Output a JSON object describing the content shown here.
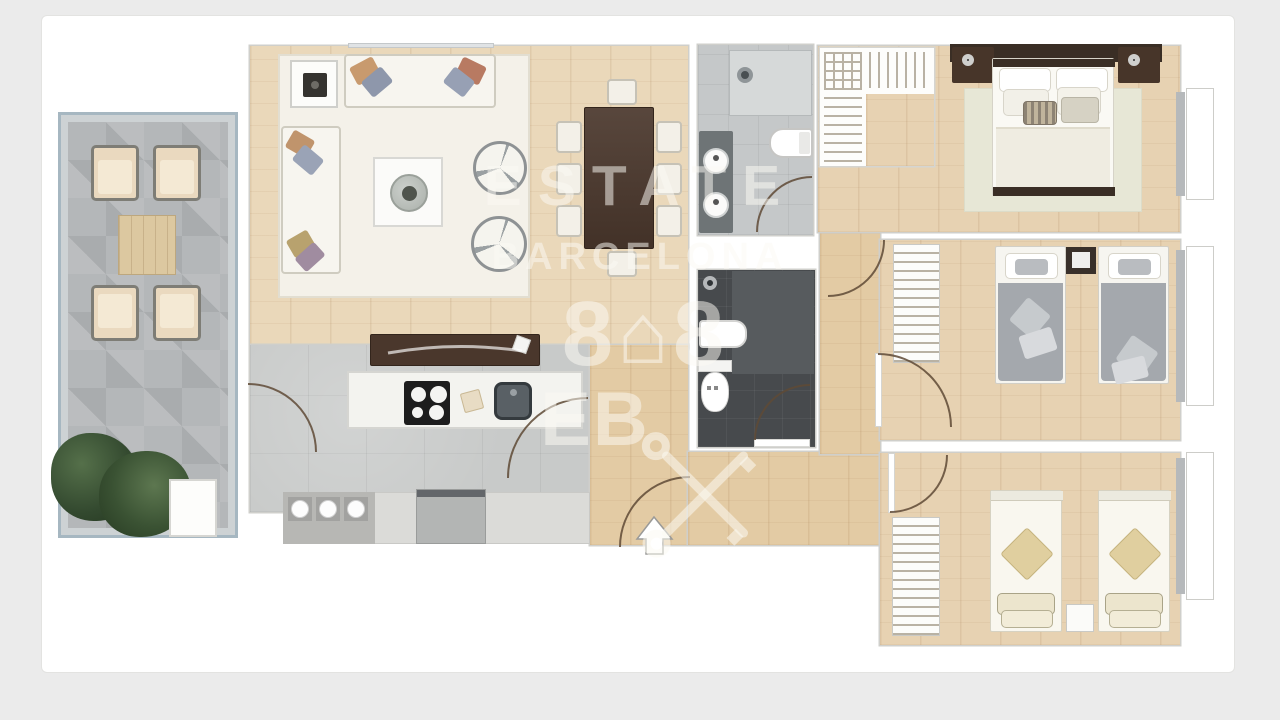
{
  "image": {
    "type": "apartment-floor-plan",
    "background_color": "#ebebeb",
    "canvas_color": "#ffffff"
  },
  "watermark": {
    "title": "ESTATE",
    "subtitle": "BARCELONA",
    "logo_left_glyph": "8",
    "logo_house_glyph": "⌂",
    "logo_right_glyph": "8",
    "monogram": "EB"
  },
  "palette": {
    "wood_floor": "#ead8ba",
    "hall_wood": "#e3cba4",
    "bedroom_wood": "#e7d2b2",
    "terrace_tile": "#b4b7b9",
    "terrace_frame": "#a6b7c1",
    "dark_wood_furniture": "#4a372c",
    "bathroom_light_floor": "#c5c8c9",
    "bathroom_dark_floor": "#474a4d",
    "kitchen_floor": "#c8cac9",
    "living_rug": "#f4f1e9",
    "master_rug": "#e7e7d6",
    "gray_bedding": "#a4a8ad",
    "cream_bedding": "#f9f7ef",
    "tan_pillow": "#e0cf9f",
    "door_arc": "#5f4a36"
  },
  "rooms": [
    "terrace",
    "living-room",
    "dining-area",
    "kitchen",
    "hallway",
    "bathroom-1",
    "bathroom-2",
    "walk-in-closet",
    "master-bedroom",
    "bedroom-2",
    "bedroom-3"
  ]
}
